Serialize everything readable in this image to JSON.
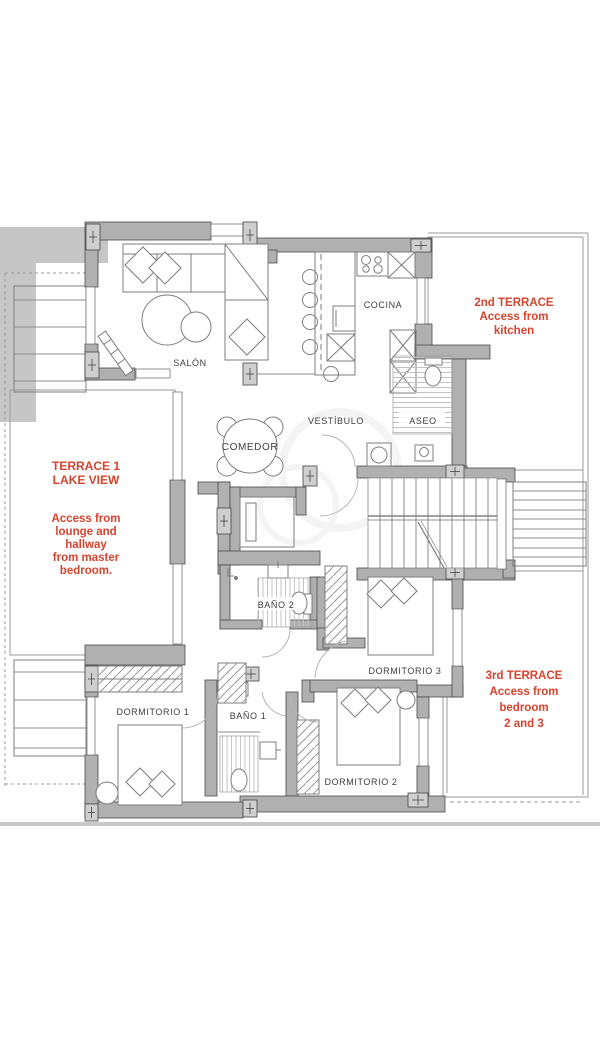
{
  "title": "apartment-floor-plan",
  "colors": {
    "wall": "#b0b0b0",
    "wall_outline": "#4a4a4a",
    "furniture_line": "#7d7d7d",
    "annotation_red": "#d8432e",
    "label_text": "#3d3d3d"
  },
  "rooms": {
    "salon": {
      "label": "SALÓN"
    },
    "cocina": {
      "label": "COCINA"
    },
    "vestibulo": {
      "label": "VESTÍBULO"
    },
    "comedor": {
      "label": "COMEDOR"
    },
    "aseo": {
      "label": "ASEO"
    },
    "bano2": {
      "label": "BAÑO 2"
    },
    "bano1": {
      "label": "BAÑO 1"
    },
    "dormitorio1": {
      "label": "DORMITORIO 1"
    },
    "dormitorio2": {
      "label": "DORMITORIO 2"
    },
    "dormitorio3": {
      "label": "DORMITORIO 3"
    }
  },
  "annotations": {
    "terrace2": {
      "color": "#d8432e",
      "lines": [
        "2nd TERRACE",
        "Access from",
        "kitchen"
      ]
    },
    "terrace1": {
      "color": "#d8432e",
      "lines": [
        "TERRACE 1",
        "LAKE VIEW",
        "Access from",
        "lounge and",
        "hallway",
        "from master",
        "bedroom."
      ]
    },
    "terrace3": {
      "color": "#d8432e",
      "lines": [
        "3rd TERRACE",
        "Access from",
        "bedroom",
        "2 and 3"
      ]
    }
  }
}
